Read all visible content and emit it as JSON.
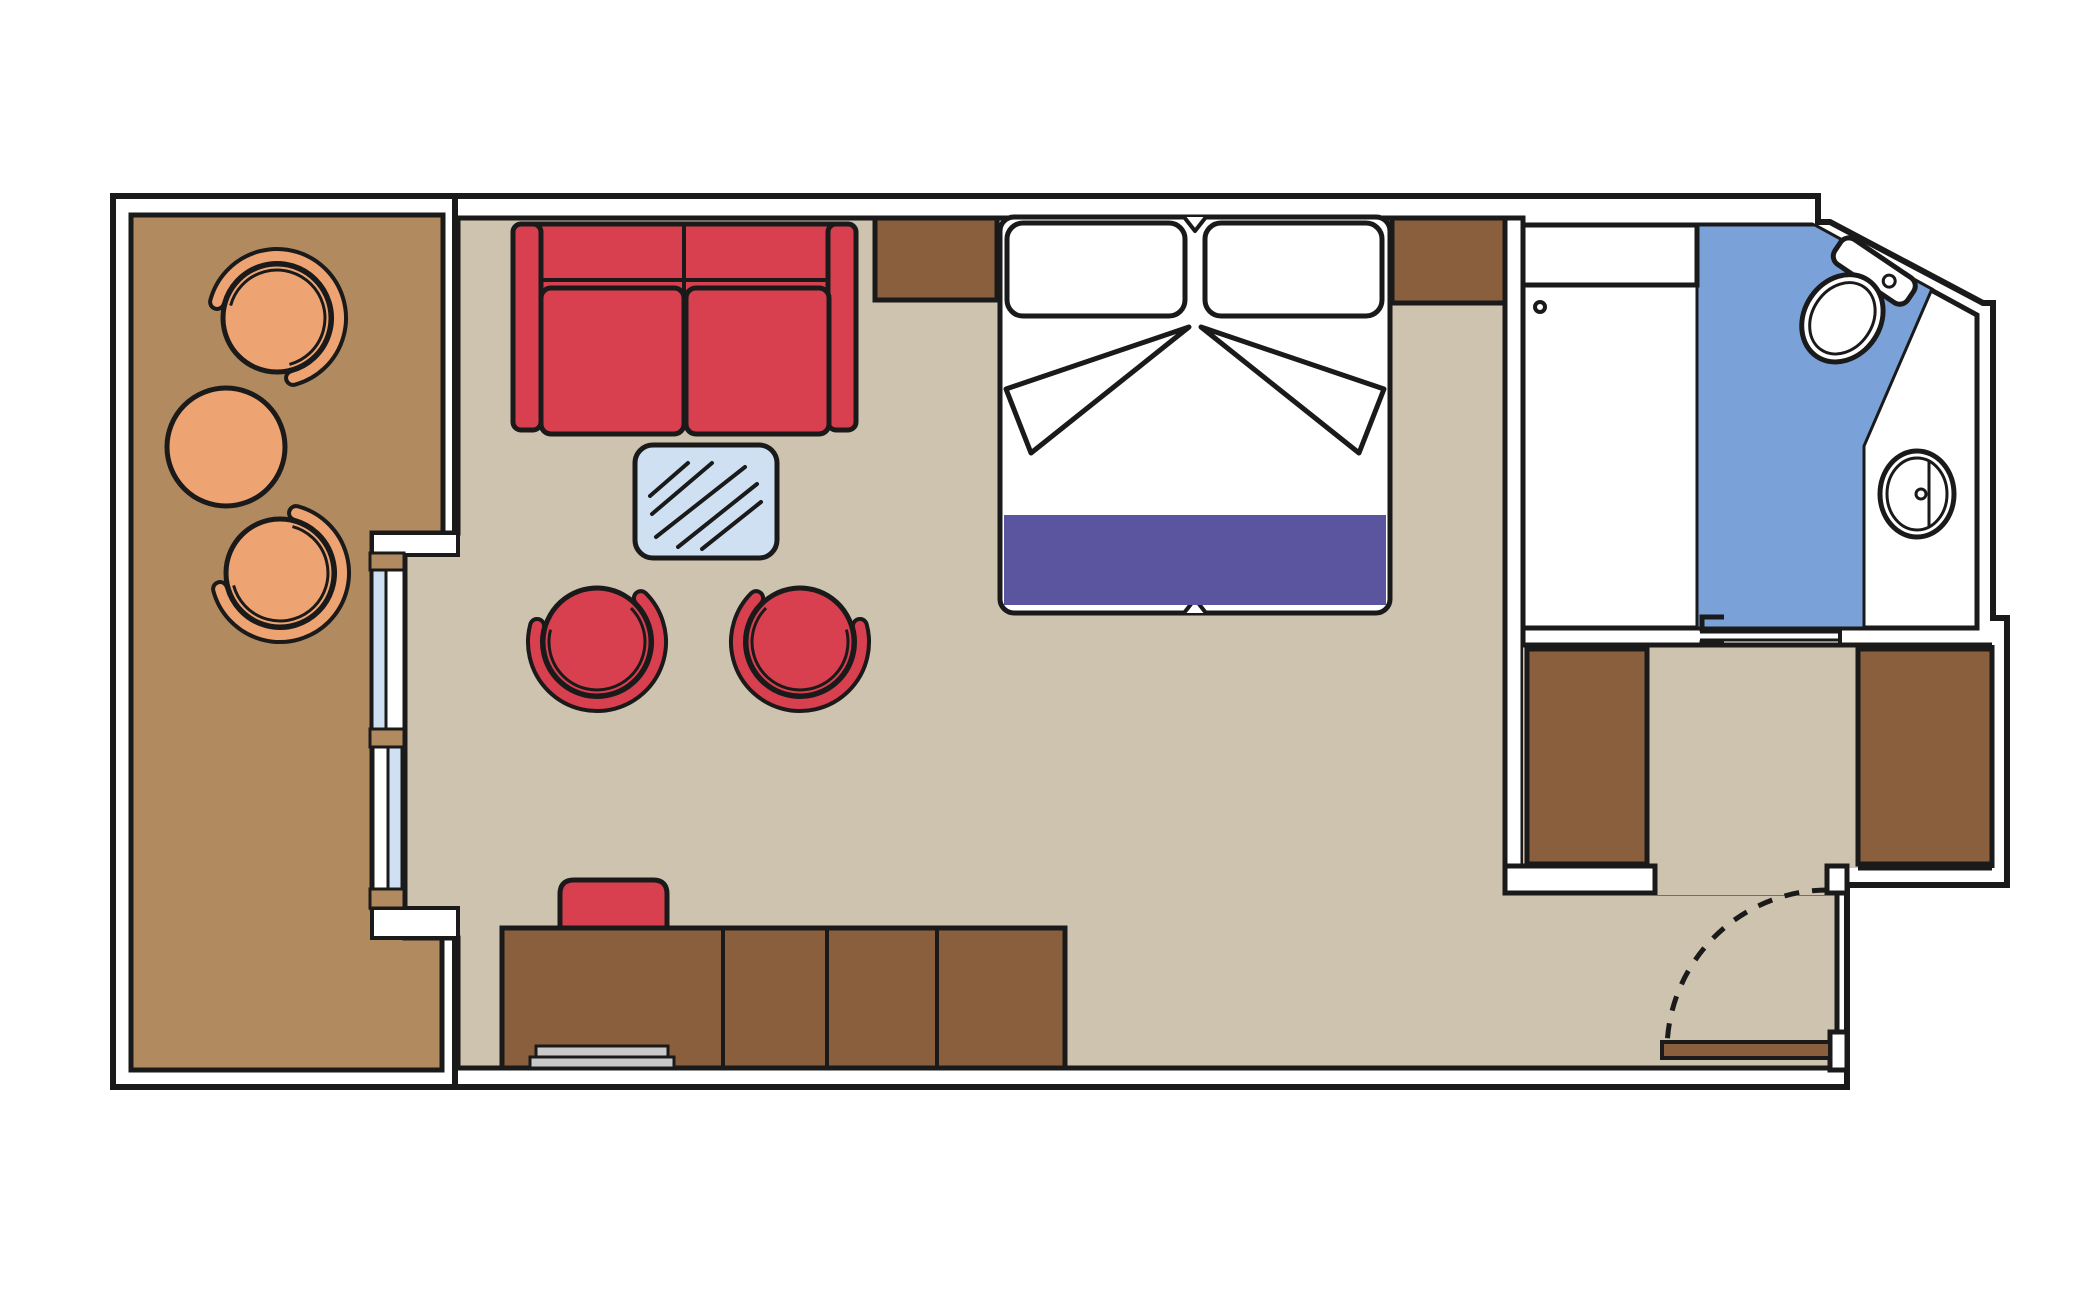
{
  "diagram": {
    "type": "floor-plan",
    "subject": "cruise-cabin suite floor plan, top-down view, no text labels",
    "rooms": [
      {
        "id": "balcony",
        "label": "Balcony",
        "furniture": [
          "tub-chair",
          "round-table",
          "tub-chair"
        ],
        "access": "sliding-glass-door"
      },
      {
        "id": "living-sleeping-area",
        "label": "Living and sleeping area",
        "furniture": [
          "two-seat-sofa",
          "glass-coffee-table",
          "tub-armchair",
          "tub-armchair",
          "double-bed",
          "nightstand",
          "nightstand",
          "desk-dresser-unit",
          "stool",
          "tray"
        ]
      },
      {
        "id": "bathroom",
        "label": "Bathroom",
        "furniture": [
          "shower",
          "toilet",
          "washbasin"
        ],
        "access": "sliding-door"
      },
      {
        "id": "entrance-hall",
        "label": "Entrance hallway",
        "furniture": [
          "wardrobe",
          "wardrobe"
        ],
        "access": "hinged-entrance-door-with-swing-arc"
      }
    ]
  },
  "colors": {
    "page_background": "#ffffff",
    "outline": "#1a1a1a",
    "wall_fill": "#ffffff",
    "balcony_floor": "#b18a60",
    "room_floor": "#cdc3ae",
    "furniture_brown": "#8a5f3e",
    "balcony_furniture": "#eda472",
    "sofa_red": "#d8404f",
    "bed_runner": "#5b549f",
    "glass": "#cfe0f2",
    "bathroom_floor": "#7ba2d8",
    "linens": "#ffffff",
    "tray_grey": "#c9c9c9"
  }
}
